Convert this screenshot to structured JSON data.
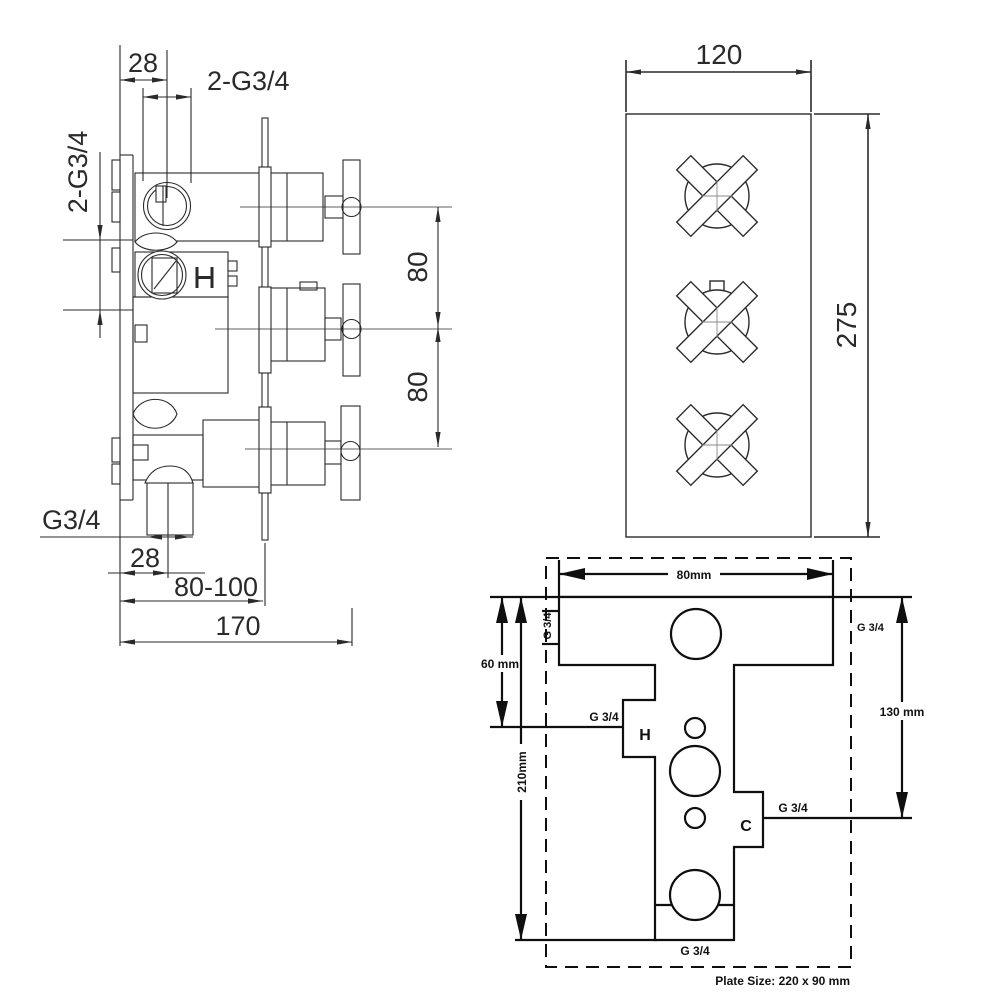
{
  "drawing": {
    "background": "#ffffff",
    "line_color": "#2a2a2a",
    "template_line_color": "#0f0f0f"
  },
  "side_view": {
    "dim_28_top": "28",
    "dim_2g34_top": "2-G3/4",
    "dim_2g34_left": "2-G3/4",
    "dim_80_upper": "80",
    "dim_80_lower": "80",
    "dim_g34_outlet": "G3/4",
    "dim_28_bottom": "28",
    "dim_80_100": "80-100",
    "dim_170": "170"
  },
  "front_view": {
    "dim_width": "120",
    "dim_height": "275"
  },
  "template_view": {
    "dim_width": "80mm",
    "dim_top_height": "60 mm",
    "dim_total_height": "210mm",
    "dim_right_height": "130 mm",
    "g34_top_left": "G 3/4",
    "g34_top_right": "G 3/4",
    "g34_hot": "G 3/4",
    "g34_cold": "G 3/4",
    "g34_bottom": "G 3/4",
    "hot_label": "H",
    "cold_label": "C",
    "plate_size": "Plate Size: 220 x 90 mm"
  }
}
